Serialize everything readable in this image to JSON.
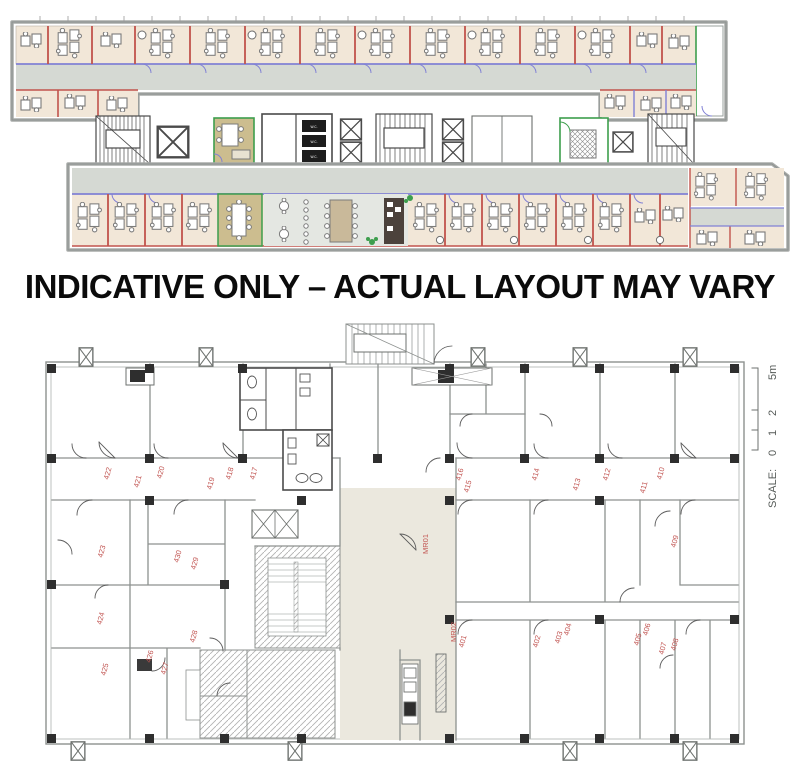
{
  "banner": {
    "text": "INDICATIVE ONLY – ACTUAL LAYOUT MAY VARY"
  },
  "top_plan": {
    "description": "indicative colored office fit-out plan",
    "wc_label": "W.C.",
    "colors": {
      "room_fill": "#f2e7d8",
      "meeting_fill": "#ccbd8f",
      "corridor": "#d5d9d3",
      "wall_red": "#c1544d",
      "wall_blue": "#8181d5",
      "wall_green": "#3d9e4d"
    }
  },
  "bottom_plan": {
    "description": "CAD shell-and-core plan with numbered rooms",
    "label_color": "#c25653",
    "rooms": [
      {
        "label": "422",
        "x": 110,
        "y": 156
      },
      {
        "label": "421",
        "x": 140,
        "y": 164
      },
      {
        "label": "420",
        "x": 163,
        "y": 155
      },
      {
        "label": "419",
        "x": 213,
        "y": 166
      },
      {
        "label": "418",
        "x": 232,
        "y": 156
      },
      {
        "label": "417",
        "x": 256,
        "y": 156
      },
      {
        "label": "416",
        "x": 462,
        "y": 157
      },
      {
        "label": "415",
        "x": 470,
        "y": 169
      },
      {
        "label": "414",
        "x": 538,
        "y": 157
      },
      {
        "label": "413",
        "x": 579,
        "y": 167
      },
      {
        "label": "412",
        "x": 609,
        "y": 157
      },
      {
        "label": "411",
        "x": 646,
        "y": 170
      },
      {
        "label": "410",
        "x": 663,
        "y": 156
      },
      {
        "label": "409",
        "x": 677,
        "y": 224
      },
      {
        "label": "MR01",
        "x": 428,
        "y": 226,
        "rot": -90
      },
      {
        "label": "423",
        "x": 104,
        "y": 234
      },
      {
        "label": "430",
        "x": 180,
        "y": 239
      },
      {
        "label": "429",
        "x": 197,
        "y": 246
      },
      {
        "label": "424",
        "x": 103,
        "y": 301
      },
      {
        "label": "428",
        "x": 196,
        "y": 319
      },
      {
        "label": "426",
        "x": 152,
        "y": 339
      },
      {
        "label": "427",
        "x": 167,
        "y": 351
      },
      {
        "label": "425",
        "x": 107,
        "y": 352
      },
      {
        "label": "MR02",
        "x": 456,
        "y": 314,
        "rot": -90
      },
      {
        "label": "401",
        "x": 465,
        "y": 324
      },
      {
        "label": "402",
        "x": 539,
        "y": 324
      },
      {
        "label": "403",
        "x": 561,
        "y": 320
      },
      {
        "label": "404",
        "x": 570,
        "y": 312
      },
      {
        "label": "405",
        "x": 640,
        "y": 322
      },
      {
        "label": "406",
        "x": 649,
        "y": 312
      },
      {
        "label": "407",
        "x": 665,
        "y": 331
      },
      {
        "label": "408",
        "x": 677,
        "y": 327
      }
    ],
    "scale": {
      "label": "SCALE:",
      "tick0": "0",
      "tick1": "1",
      "tick2": "2",
      "tick5": "5m"
    }
  }
}
